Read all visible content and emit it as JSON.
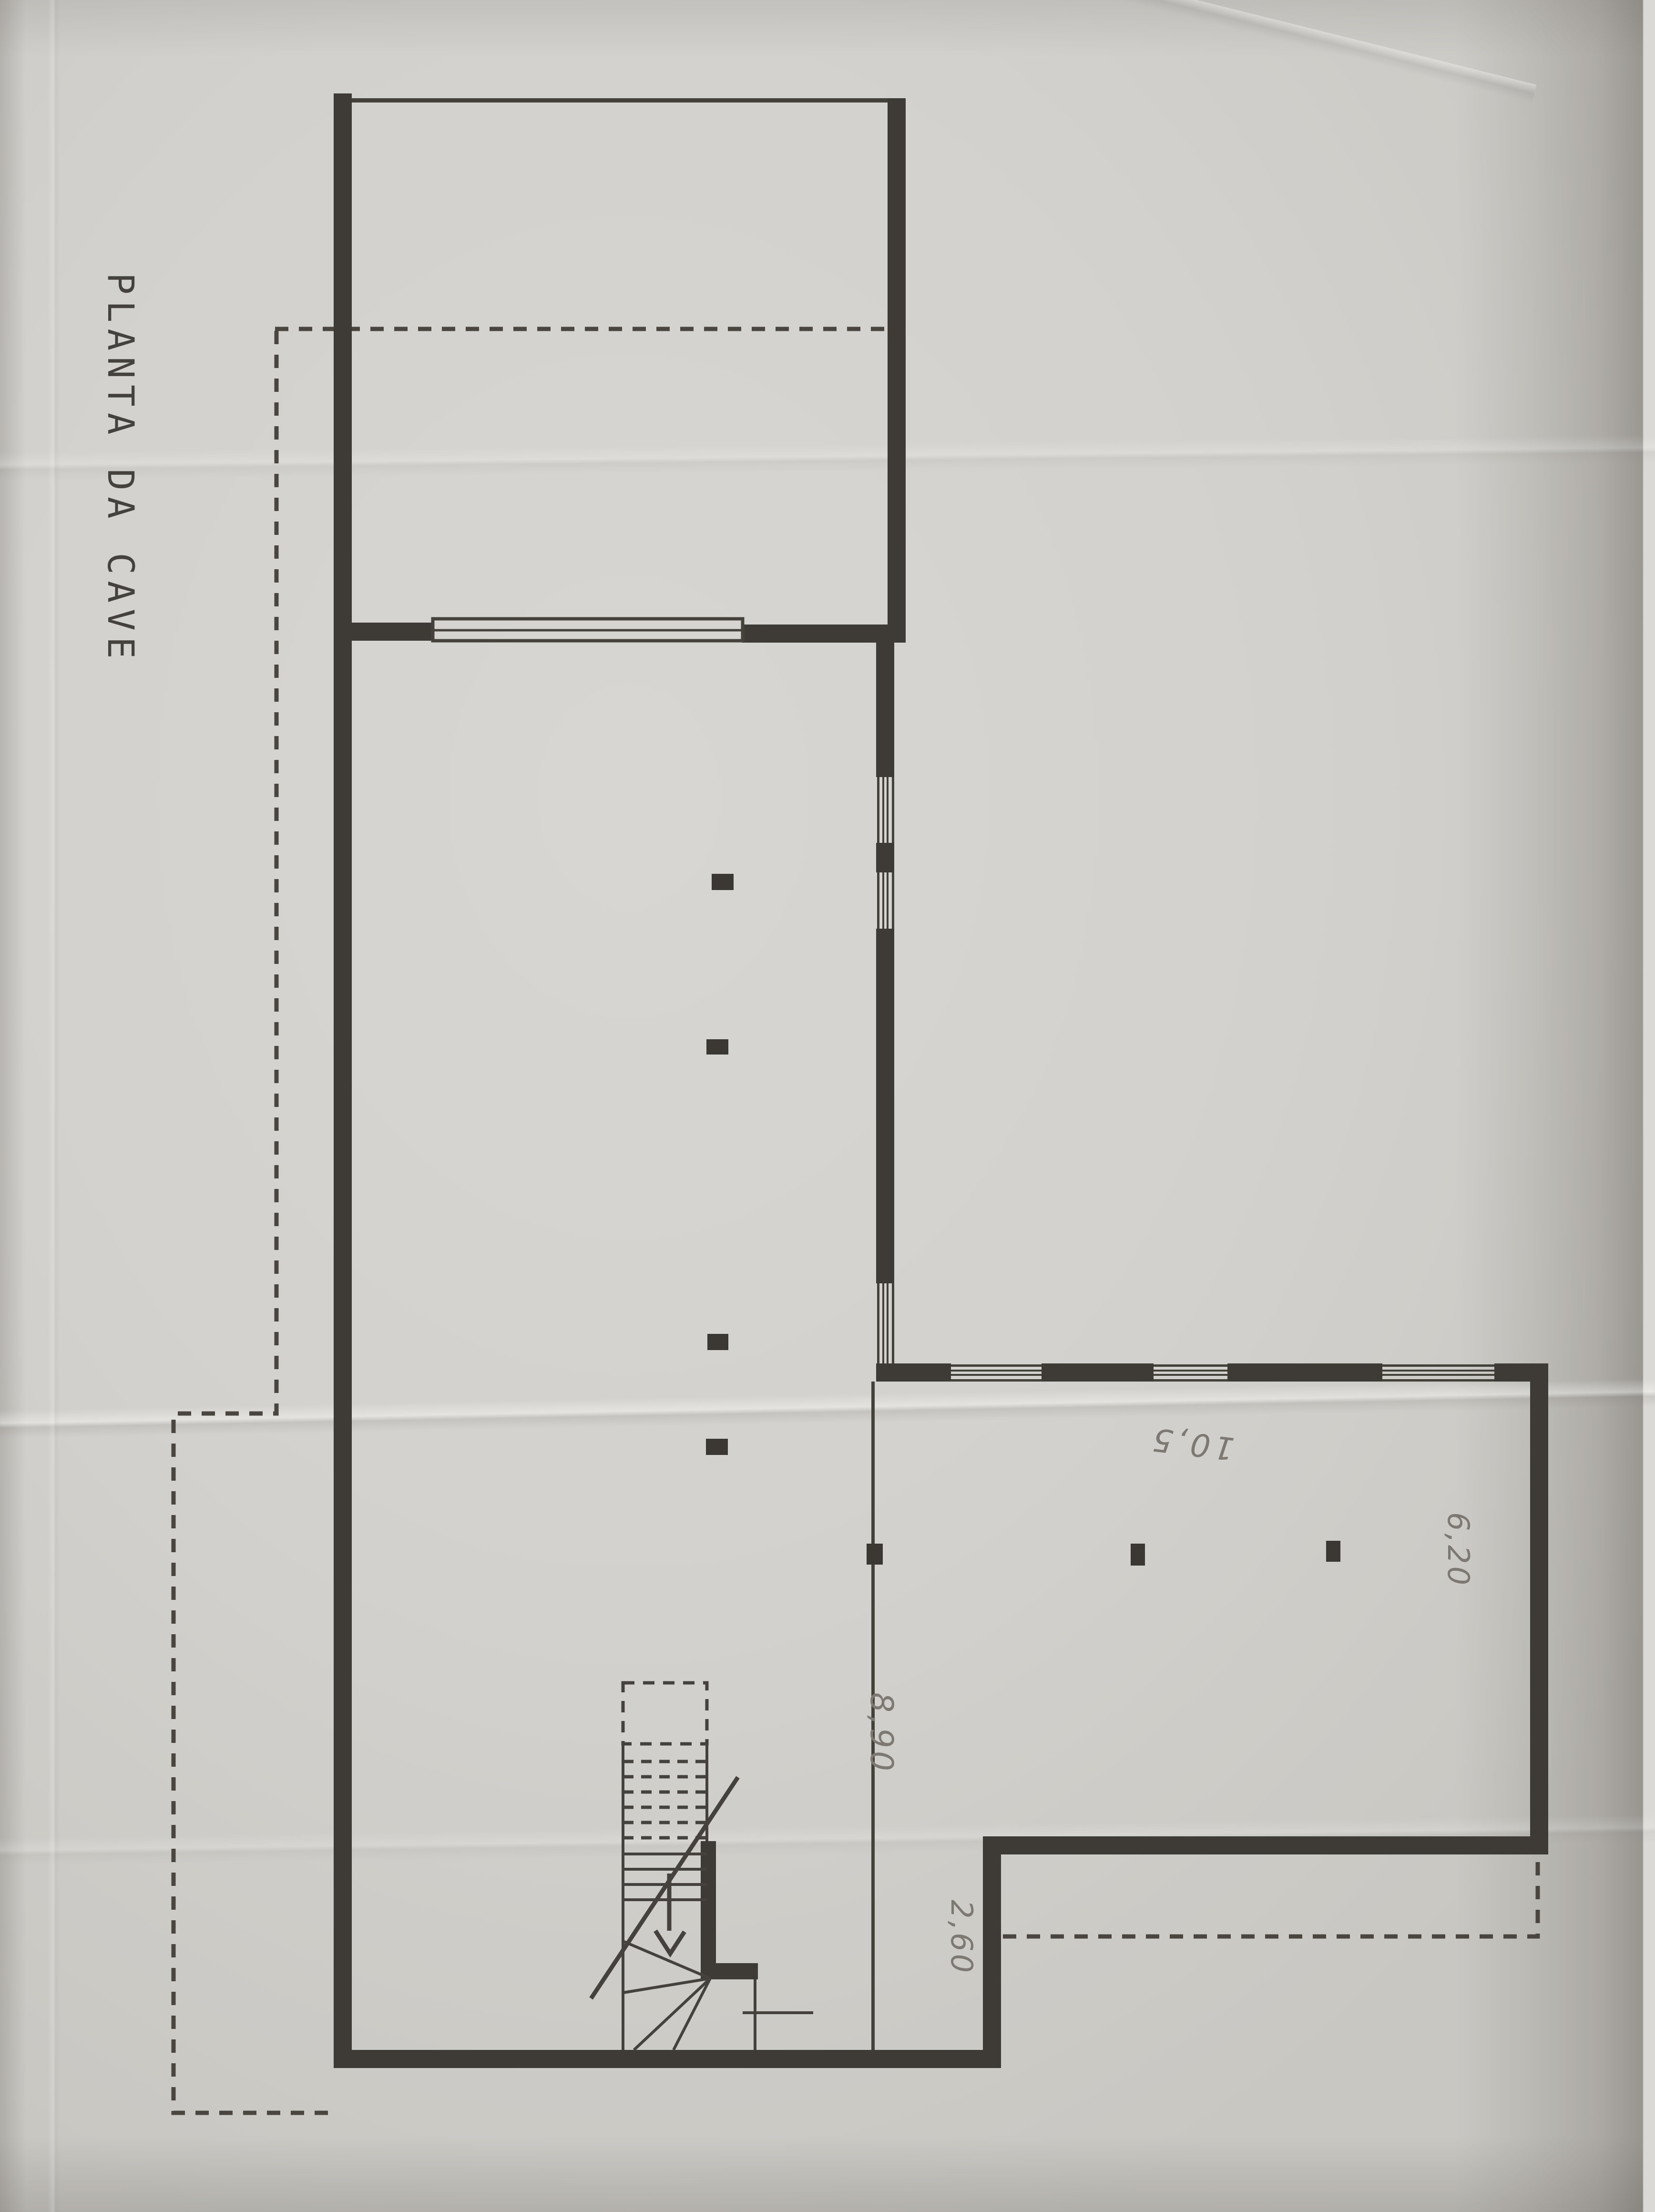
{
  "document": {
    "title": "PLANTA DA CAVE",
    "kind": "scanned basement floor plan drawing"
  },
  "plan": {
    "title": "PLANTA DA CAVE",
    "dimension_labels": [
      {
        "id": "dim-8-90",
        "text": "8,90"
      },
      {
        "id": "dim-2-60",
        "text": "2,60"
      },
      {
        "id": "dim-10-5",
        "text": "10,5"
      },
      {
        "id": "dim-6-20",
        "text": "6,20"
      }
    ]
  },
  "colors": {
    "paper": "#d3d1cd",
    "ink": "#3e3b36",
    "pencil": "#7d7872",
    "shadow_edge": "#8f8b84"
  }
}
